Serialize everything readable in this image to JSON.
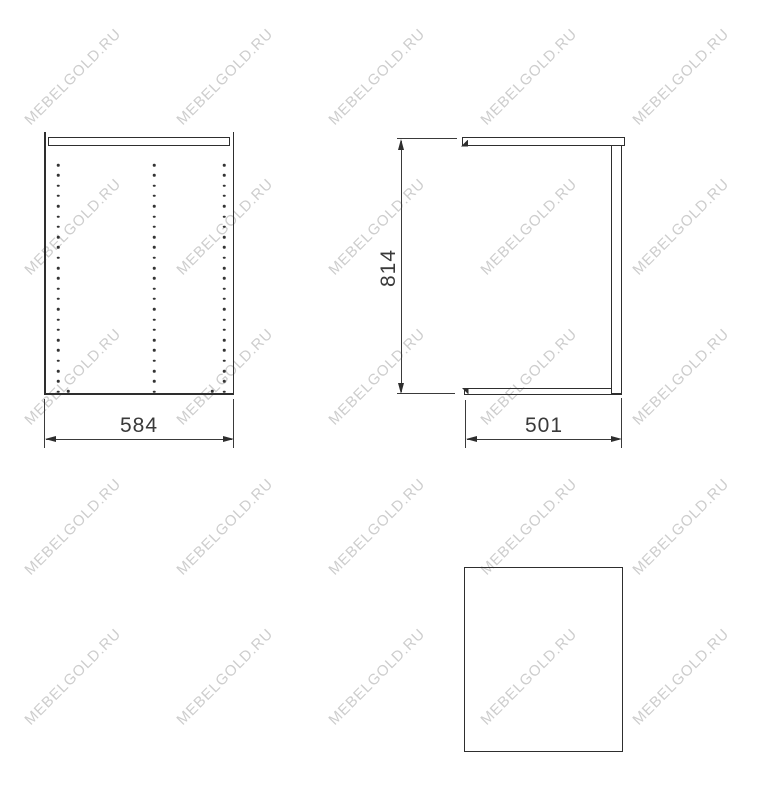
{
  "page": {
    "background": "#ffffff"
  },
  "watermark": {
    "text": "MEBELGOLD.RU",
    "color": "#cdcdcd",
    "cols": [
      73,
      225,
      377,
      529,
      681
    ],
    "rows": [
      77,
      227,
      377,
      527,
      677
    ]
  },
  "drawing": {
    "line_color": "#2e2e2e",
    "text_color": "#3a3a3a",
    "front_view": {
      "width_label": "584",
      "holes": {
        "columns_x": [
          58,
          154,
          224
        ],
        "start_y": 165,
        "step_y": 10.3,
        "rows": 23,
        "bottom_extra_x": [
          68,
          212
        ],
        "bottom_extra_y": 391
      }
    },
    "side_view": {
      "height_label": "814",
      "depth_label": "501"
    }
  }
}
